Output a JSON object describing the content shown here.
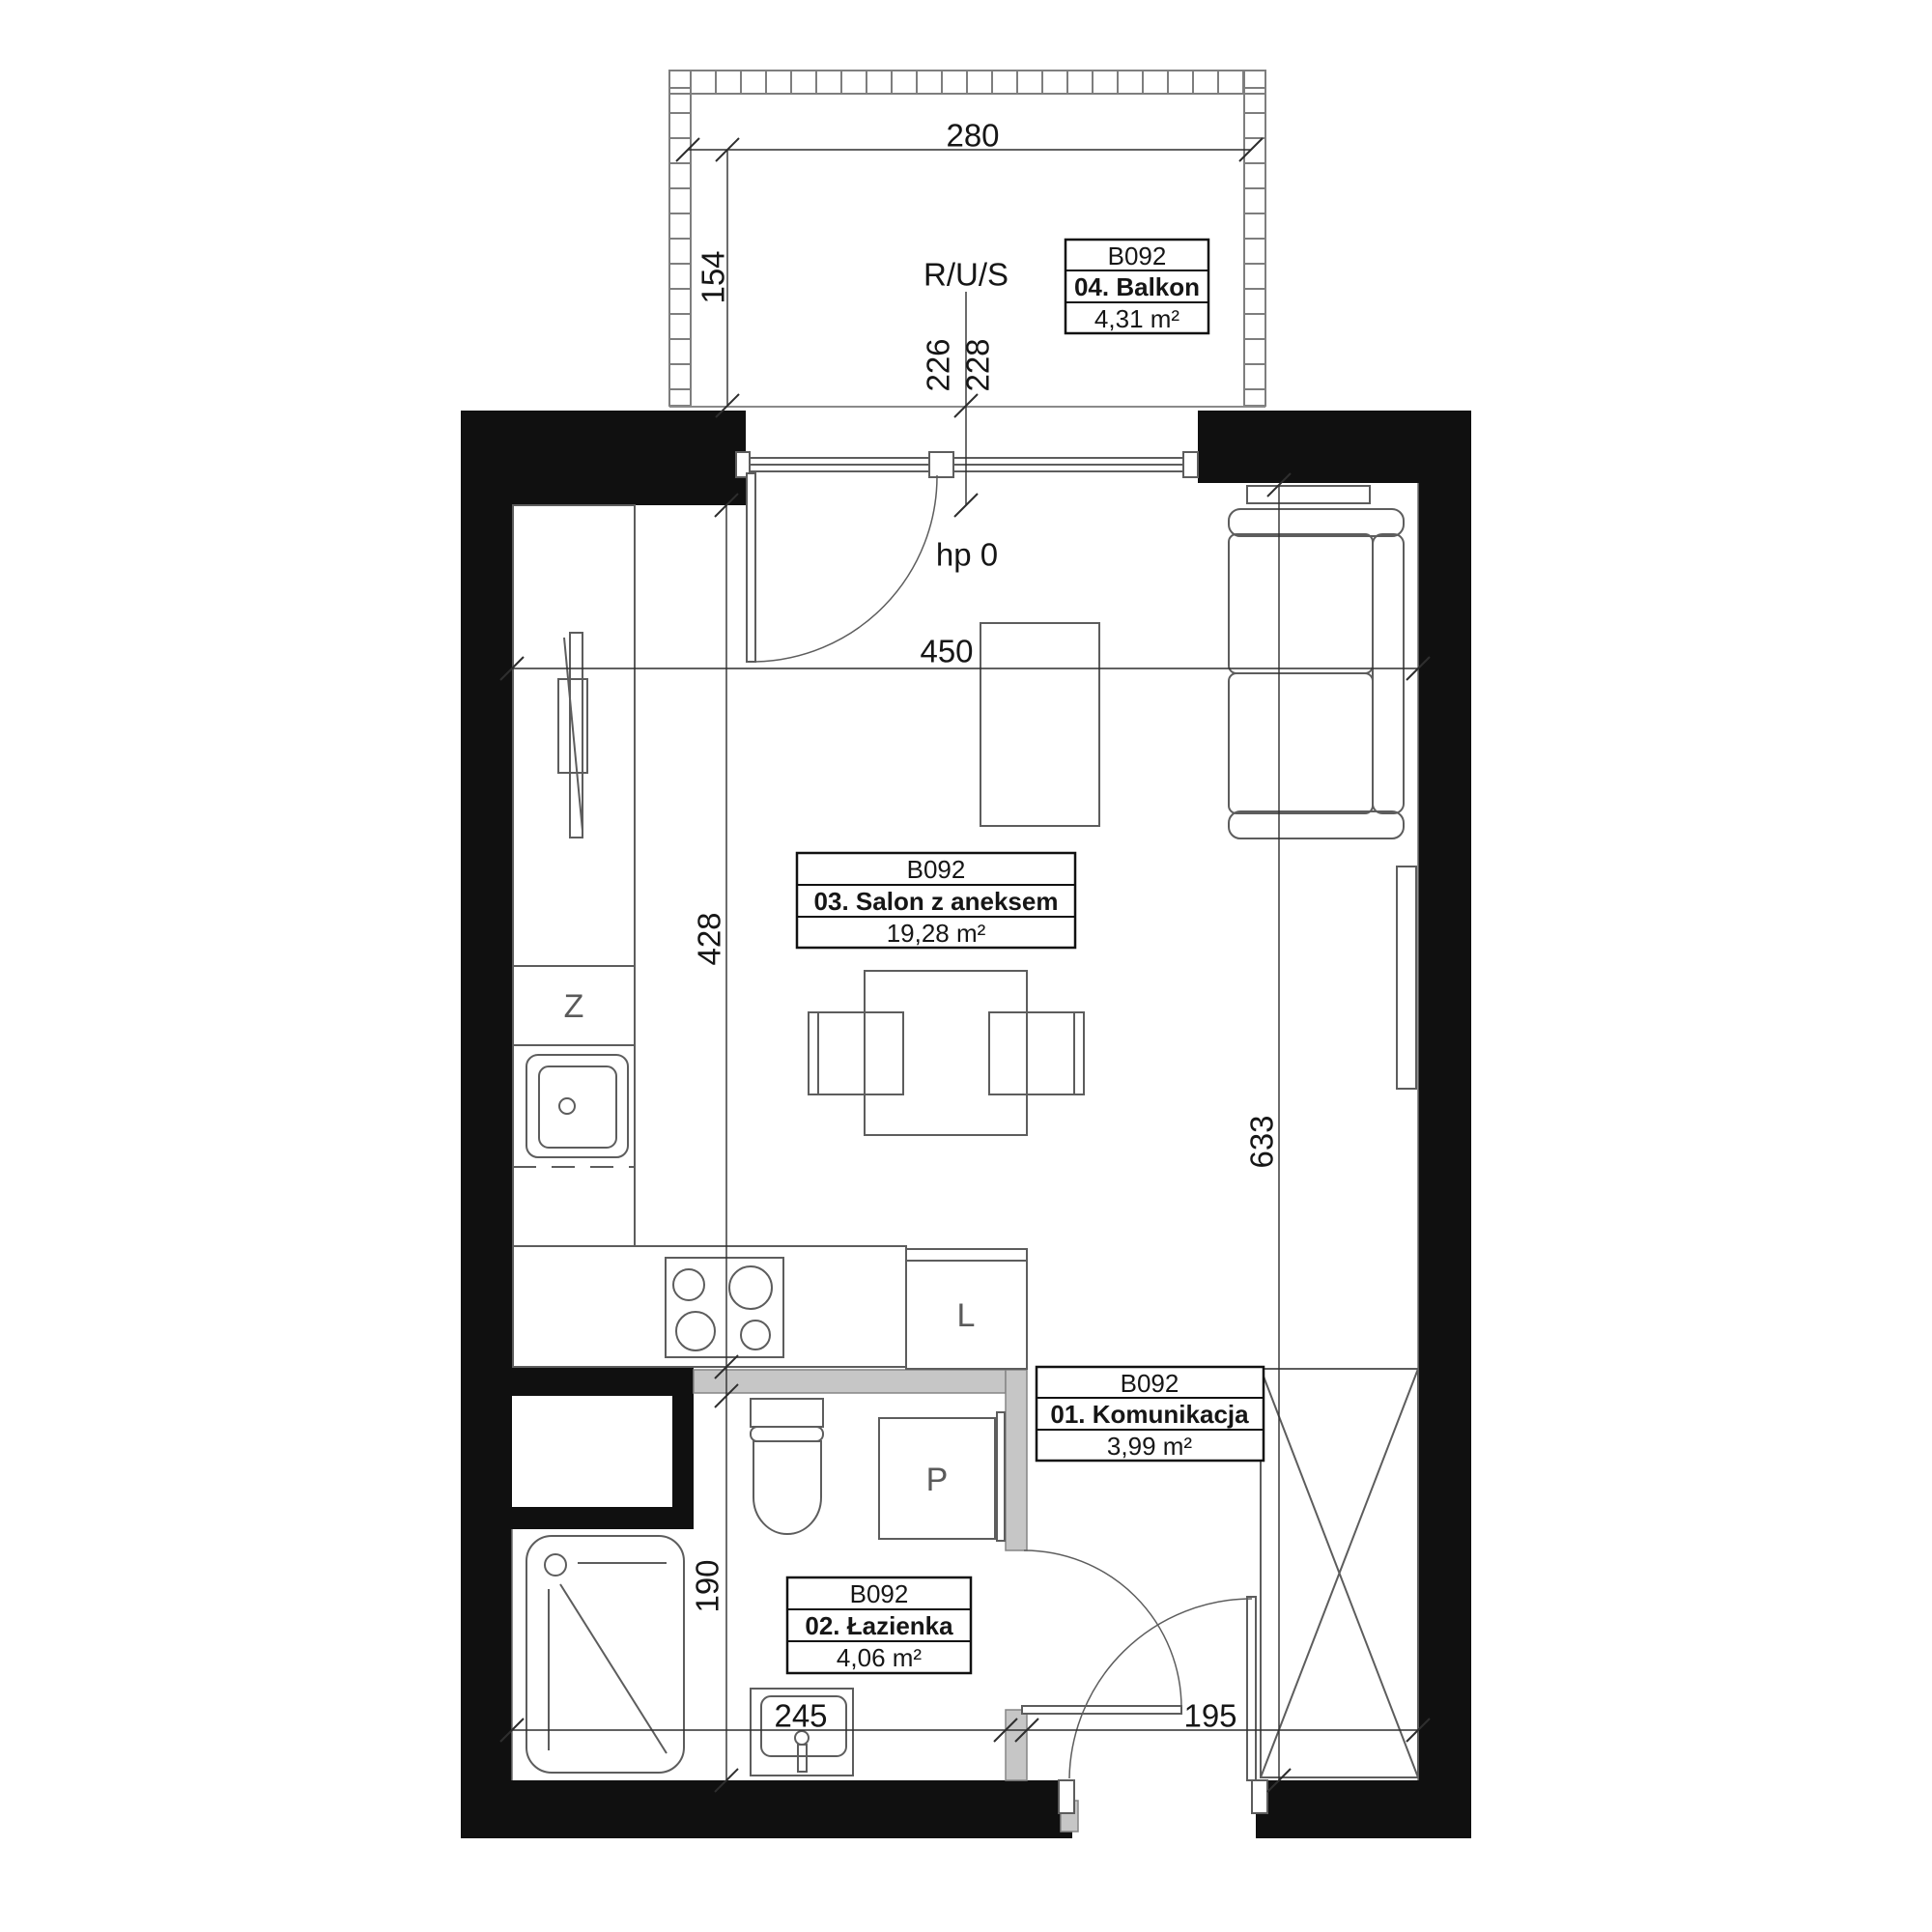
{
  "floor_plan": {
    "unit_id": "B092",
    "rooms": [
      {
        "id": "B092",
        "name": "01. Komunikacja",
        "area": "3,99 m²"
      },
      {
        "id": "B092",
        "name": "02. Łazienka",
        "area": "4,06 m²"
      },
      {
        "id": "B092",
        "name": "03. Salon z aneksem",
        "area": "19,28 m²"
      },
      {
        "id": "B092",
        "name": "04. Balkon",
        "area": "4,31 m²"
      }
    ],
    "dimensions": {
      "d280": "280",
      "d154": "154",
      "d226": "226",
      "d228": "228",
      "d450": "450",
      "d428": "428",
      "d633": "633",
      "d190": "190",
      "d245": "245",
      "d195": "195"
    },
    "annotations": {
      "riser": "R/U/S",
      "sill_height": "hp 0"
    },
    "appliances": {
      "dishwasher": "Z",
      "fridge": "L",
      "washer": "P"
    },
    "colors": {
      "exterior_wall": "#101010",
      "partition_wall": "#c6c6c6",
      "line": "#5d5d5d"
    }
  }
}
